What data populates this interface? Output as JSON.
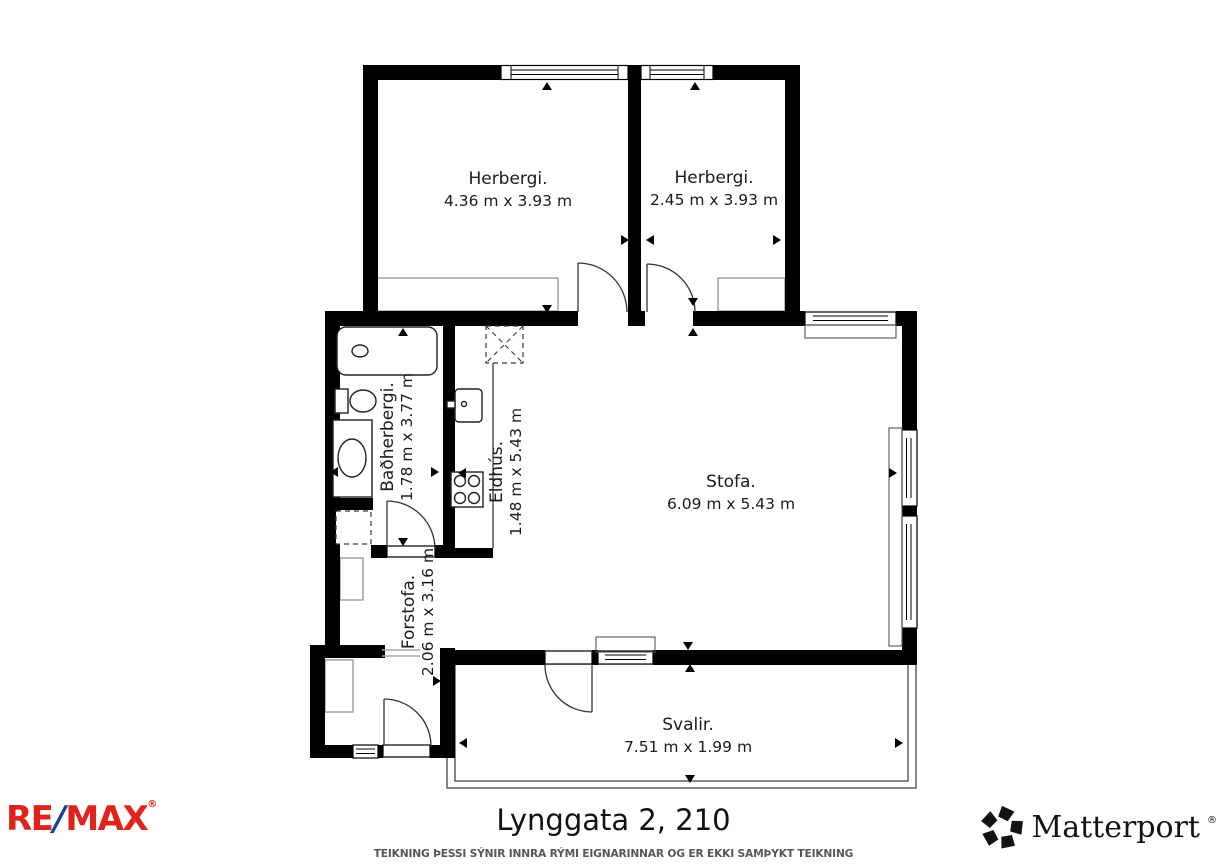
{
  "floorplan": {
    "rooms": [
      {
        "name": "Herbergi.",
        "dims": "4.36 m x 3.93 m"
      },
      {
        "name": "Herbergi.",
        "dims": "2.45 m x 3.93 m"
      },
      {
        "name": "Baðherbergi.",
        "dims": "1.78 m x 3.77 m"
      },
      {
        "name": "Eldhús.",
        "dims": "1.48 m x 5.43 m"
      },
      {
        "name": "Stofa.",
        "dims": "6.09 m x 5.43 m"
      },
      {
        "name": "Forstofa.",
        "dims": "2.06 m x 3.16 m"
      },
      {
        "name": "Svalir.",
        "dims": "7.51 m x 1.99 m"
      }
    ]
  },
  "footer": {
    "title": "Lynggata 2, 210",
    "disclaimer": "TEIKNING ÞESSI SÝNIR INNRA RÝMI EIGNARINNAR OG ER EKKI SAMÞYKT TEIKNING",
    "remax": {
      "part1": "RE",
      "slash": "/",
      "part2": "MAX",
      "reg": "®"
    },
    "matterport": {
      "label": "Matterport",
      "reg": "®"
    }
  },
  "colors": {
    "wall": "#000000",
    "remax_red": "#e2231c",
    "remax_blue": "#1c3f94"
  }
}
